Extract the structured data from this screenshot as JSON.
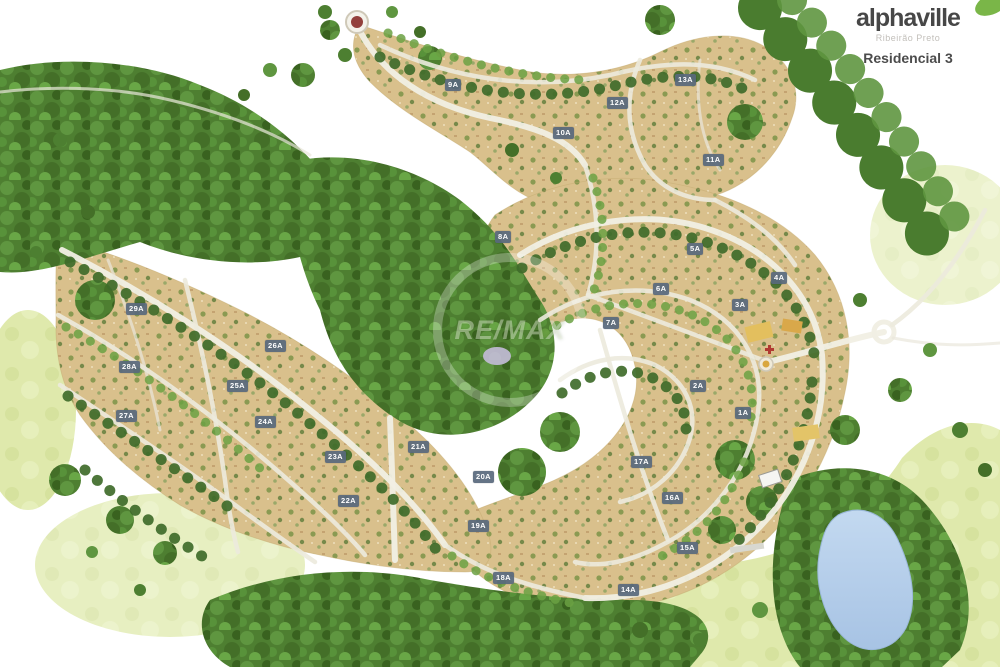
{
  "branding": {
    "name": "alphaville",
    "location": "Ribeirão Preto",
    "project": "Residencial 3"
  },
  "watermark": {
    "text": "RE/MAX"
  },
  "map": {
    "type": "residential-masterplan-illustration",
    "block_labels": [
      {
        "text": "1A",
        "x": 745,
        "y": 413
      },
      {
        "text": "2A",
        "x": 700,
        "y": 386
      },
      {
        "text": "3A",
        "x": 742,
        "y": 305
      },
      {
        "text": "4A",
        "x": 781,
        "y": 278
      },
      {
        "text": "5A",
        "x": 697,
        "y": 249
      },
      {
        "text": "6A",
        "x": 663,
        "y": 289
      },
      {
        "text": "7A",
        "x": 613,
        "y": 323
      },
      {
        "text": "8A",
        "x": 505,
        "y": 237
      },
      {
        "text": "9A",
        "x": 455,
        "y": 85
      },
      {
        "text": "10A",
        "x": 563,
        "y": 133
      },
      {
        "text": "11A",
        "x": 713,
        "y": 160
      },
      {
        "text": "12A",
        "x": 617,
        "y": 103
      },
      {
        "text": "13A",
        "x": 685,
        "y": 80
      },
      {
        "text": "14A",
        "x": 628,
        "y": 590
      },
      {
        "text": "15A",
        "x": 687,
        "y": 548
      },
      {
        "text": "16A",
        "x": 672,
        "y": 498
      },
      {
        "text": "17A",
        "x": 641,
        "y": 462
      },
      {
        "text": "18A",
        "x": 503,
        "y": 578
      },
      {
        "text": "19A",
        "x": 478,
        "y": 526
      },
      {
        "text": "20A",
        "x": 483,
        "y": 477
      },
      {
        "text": "21A",
        "x": 418,
        "y": 447
      },
      {
        "text": "22A",
        "x": 348,
        "y": 501
      },
      {
        "text": "23A",
        "x": 335,
        "y": 457
      },
      {
        "text": "24A",
        "x": 265,
        "y": 422
      },
      {
        "text": "25A",
        "x": 237,
        "y": 386
      },
      {
        "text": "26A",
        "x": 275,
        "y": 346
      },
      {
        "text": "27A",
        "x": 126,
        "y": 416
      },
      {
        "text": "28A",
        "x": 129,
        "y": 367
      },
      {
        "text": "29A",
        "x": 136,
        "y": 309
      }
    ],
    "colors": {
      "lot_field": "#d9c08c",
      "forest": "#4e7f31",
      "meadow": "#dfe9ac",
      "road": "#f1efe4",
      "lake": "#b9d2ec",
      "label_bg": "#58687c",
      "roundabout_center": "#93403c",
      "club_buildings": "#e3bf5e"
    }
  }
}
